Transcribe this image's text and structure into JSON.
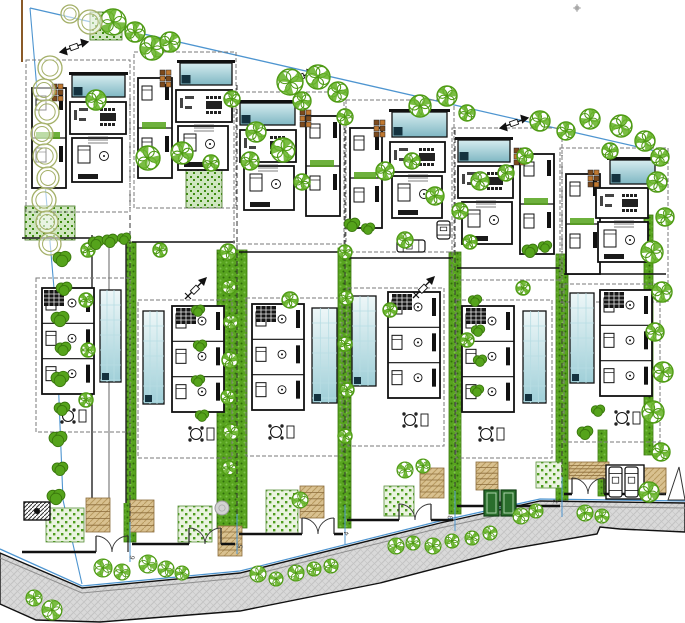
{
  "meta": {
    "type": "architectural-site-plan",
    "plots_count": 6
  },
  "canvas": {
    "w": 685,
    "h": 623,
    "bg": "#ffffff"
  },
  "colors": {
    "boundary_blue": "#4e95d0",
    "wall_black": "#111111",
    "dash_gray": "#7a7a7a",
    "road_gray": "#d9d9d9",
    "road_hatch": "#c3c3c3",
    "tree_green": "#4e9a14",
    "tree_patch": "#68b42a",
    "bush_green": "#55a31b",
    "bush_edge": "#3a770d",
    "olive": "#a4b068",
    "hedge_base": "#58a41f",
    "hedge_dark": "#2f6c0c",
    "hedge_light": "#7cc24a",
    "lawn_base": "#eaf3e0",
    "lawn_dot": "#4e9c1e",
    "garden_base": "#cfe6c0",
    "garden_dot": "#3f8c12",
    "pool_light": "#d6ecef",
    "pool_teal": "#7fb7c3",
    "pool_pale": "#eef7f8",
    "pool_mid": "#9fcfd8",
    "pool_lane": "#b7dde3",
    "navy": "#14323f",
    "tan": "#d9c190",
    "tan_line": "#b89a60",
    "tan_edge": "#8a6b3a",
    "brown_dark": "#7c4a1d",
    "brown_light": "#c07830",
    "pole_brown": "#8a5a28",
    "door_green": "#2a6e2c",
    "door_green_dark": "#123f14",
    "label_ink": "#444444"
  },
  "boundaries": {
    "top_line": [
      [
        30,
        8
      ],
      [
        660,
        152
      ]
    ],
    "left_line": [
      [
        30,
        8
      ],
      [
        55,
        300
      ],
      [
        63,
        500
      ],
      [
        82,
        584
      ]
    ],
    "front_line": [
      [
        0,
        549
      ],
      [
        82,
        586
      ],
      [
        240,
        571
      ],
      [
        440,
        521
      ],
      [
        540,
        499
      ],
      [
        685,
        501
      ]
    ],
    "marker_pole": {
      "x": 22,
      "y1": 0,
      "y2": 62
    },
    "asterisk": [
      577,
      8
    ]
  },
  "road": {
    "top": [
      [
        0,
        553
      ],
      [
        82,
        588
      ],
      [
        240,
        573
      ],
      [
        440,
        523
      ],
      [
        540,
        501
      ],
      [
        685,
        503
      ]
    ],
    "bottom": [
      [
        0,
        604
      ],
      [
        36,
        620
      ],
      [
        100,
        622
      ],
      [
        240,
        611
      ],
      [
        380,
        583
      ],
      [
        510,
        549
      ],
      [
        597,
        534
      ],
      [
        600,
        527
      ],
      [
        620,
        529
      ],
      [
        685,
        532
      ]
    ],
    "curb_offset": 5
  },
  "dividers": [
    {
      "x": 130,
      "y1": 95,
      "y2": 548
    },
    {
      "x": 237,
      "y1": 85,
      "y2": 540
    },
    {
      "x": 345,
      "y1": 120,
      "y2": 531
    },
    {
      "x": 455,
      "y1": 130,
      "y2": 517
    },
    {
      "x": 562,
      "y1": 155,
      "y2": 503
    }
  ],
  "plots": [
    {
      "label": "6",
      "x": 20,
      "w": 110,
      "wallY": 552,
      "zoneY": 238,
      "gateX": 112,
      "upper": {
        "pool": [
          72,
          75,
          53,
          22
        ],
        "wing": [
          32,
          88,
          34,
          100
        ],
        "living": [
          70,
          102,
          56,
          32
        ],
        "master": [
          72,
          138,
          50,
          44
        ],
        "dashed": [
          26,
          60,
          104,
          152
        ],
        "furn": [
          52,
          84
        ]
      },
      "lower": {
        "pool": [
          100,
          290,
          21,
          92
        ],
        "rooms": [
          42,
          288,
          52,
          106
        ],
        "dashed": [
          36,
          278,
          94,
          154
        ],
        "stairs": [
          44,
          290
        ],
        "table": [
          68,
          416
        ]
      }
    },
    {
      "label": "5",
      "x": 130,
      "w": 107,
      "wallY": 544,
      "zoneY": 242,
      "gateX": 205,
      "upper": {
        "pool": [
          180,
          63,
          52,
          22
        ],
        "wing": [
          138,
          78,
          34,
          100
        ],
        "living": [
          176,
          90,
          56,
          32
        ],
        "master": [
          178,
          126,
          50,
          44
        ],
        "dashed": [
          134,
          52,
          102,
          156
        ],
        "furn": [
          160,
          70
        ]
      },
      "lower": {
        "pool": [
          143,
          311,
          21,
          93
        ],
        "rooms": [
          172,
          306,
          52,
          106
        ],
        "dashed": [
          138,
          300,
          94,
          158
        ],
        "stairs": [
          176,
          308
        ],
        "table": [
          196,
          434
        ]
      }
    },
    {
      "label": "4",
      "x": 237,
      "w": 108,
      "wallY": 534,
      "zoneY": 252,
      "gateX": 318,
      "upper": {
        "pool": [
          240,
          103,
          55,
          22
        ],
        "wing": [
          306,
          116,
          34,
          100
        ],
        "living": [
          240,
          130,
          56,
          32
        ],
        "master": [
          244,
          166,
          50,
          44
        ],
        "dashed": [
          234,
          92,
          110,
          152
        ],
        "furn": [
          300,
          110
        ]
      },
      "lower": {
        "pool": [
          312,
          308,
          25,
          95
        ],
        "rooms": [
          252,
          304,
          52,
          106
        ],
        "dashed": [
          246,
          298,
          96,
          158
        ],
        "stairs": [
          256,
          306
        ],
        "table": [
          276,
          432
        ]
      }
    },
    {
      "label": "3",
      "x": 345,
      "w": 110,
      "wallY": 520,
      "zoneY": 258,
      "gateX": 415,
      "upper": {
        "pool": [
          392,
          112,
          55,
          25
        ],
        "wing": [
          350,
          128,
          32,
          100
        ],
        "living": [
          390,
          142,
          55,
          30
        ],
        "master": [
          392,
          176,
          50,
          42
        ],
        "dashed": [
          346,
          100,
          108,
          152
        ],
        "furn": [
          374,
          120
        ]
      },
      "lower": {
        "pool": [
          352,
          296,
          24,
          90
        ],
        "rooms": [
          388,
          292,
          52,
          106
        ],
        "dashed": [
          348,
          288,
          96,
          158
        ],
        "stairs": [
          392,
          294
        ],
        "table": [
          410,
          420
        ]
      }
    },
    {
      "label": "2",
      "x": 455,
      "w": 107,
      "wallY": 506,
      "zoneY": 268,
      "gateX": 500,
      "upper": {
        "pool": [
          458,
          140,
          52,
          22
        ],
        "wing": [
          520,
          154,
          34,
          100
        ],
        "living": [
          458,
          166,
          55,
          32
        ],
        "master": [
          462,
          202,
          50,
          42
        ],
        "dashed": [
          452,
          128,
          110,
          152
        ],
        "furn": [
          514,
          148
        ]
      },
      "lower": {
        "pool": [
          523,
          311,
          23,
          92
        ],
        "rooms": [
          462,
          306,
          52,
          106
        ],
        "dashed": [
          456,
          300,
          96,
          158
        ],
        "stairs": [
          466,
          308
        ],
        "table": [
          486,
          434
        ]
      }
    },
    {
      "label": "1",
      "x": 562,
      "w": 106,
      "wallY": 494,
      "zoneY": 274,
      "gateX": 588,
      "upper": {
        "pool": [
          610,
          160,
          45,
          24
        ],
        "wing": [
          566,
          174,
          34,
          100
        ],
        "living": [
          596,
          188,
          52,
          30
        ],
        "master": [
          598,
          222,
          50,
          40
        ],
        "dashed": [
          560,
          148,
          108,
          154
        ],
        "furn": [
          588,
          170
        ]
      },
      "lower": {
        "pool": [
          570,
          293,
          24,
          90
        ],
        "rooms": [
          600,
          290,
          52,
          106
        ],
        "dashed": [
          564,
          284,
          96,
          158
        ],
        "stairs": [
          604,
          292
        ],
        "table": [
          622,
          418
        ]
      }
    }
  ],
  "labels": [
    {
      "t": "6",
      "x": 134,
      "y": 560
    },
    {
      "t": "5",
      "x": 242,
      "y": 549
    },
    {
      "t": "4",
      "x": 348,
      "y": 536
    },
    {
      "t": "3",
      "x": 452,
      "y": 520
    },
    {
      "t": "2",
      "x": 557,
      "y": 504
    },
    {
      "t": "1",
      "x": 664,
      "y": 496
    }
  ],
  "hedges": [
    [
      124,
      242,
      12,
      300
    ],
    [
      217,
      250,
      30,
      278
    ],
    [
      338,
      248,
      13,
      280
    ],
    [
      449,
      252,
      12,
      262
    ],
    [
      556,
      254,
      12,
      246
    ],
    [
      598,
      430,
      9,
      66
    ],
    [
      644,
      215,
      9,
      240
    ]
  ],
  "lawns": [
    [
      46,
      508,
      38,
      34
    ],
    [
      178,
      506,
      34,
      36
    ],
    [
      266,
      490,
      32,
      44
    ],
    [
      384,
      486,
      30,
      30
    ],
    [
      536,
      462,
      26,
      26
    ]
  ],
  "gardens": [
    [
      186,
      166,
      36,
      42
    ],
    [
      25,
      206,
      50,
      34
    ],
    [
      90,
      12,
      32,
      28
    ]
  ],
  "walkways": [
    [
      86,
      498,
      24,
      34
    ],
    [
      130,
      500,
      24,
      32
    ],
    [
      218,
      526,
      24,
      30
    ],
    [
      300,
      486,
      24,
      32
    ],
    [
      420,
      468,
      24,
      30
    ],
    [
      476,
      462,
      22,
      28
    ],
    [
      569,
      462,
      40,
      17
    ]
  ],
  "tan_pads": [
    [
      642,
      468,
      24,
      25
    ]
  ],
  "ramp_triangle": [
    [
      668,
      500
    ],
    [
      679,
      467
    ],
    [
      685,
      500
    ]
  ],
  "driveway": {
    "lane": [
      92,
      235,
      34,
      268
    ]
  },
  "gate_box": [
    24,
    502,
    26,
    18
  ],
  "green_doors": [
    [
      484,
      490,
      15,
      26
    ],
    [
      501,
      490,
      15,
      26
    ]
  ],
  "parking": {
    "bay": [
      606,
      465,
      38,
      34
    ],
    "cars": [
      [
        609,
        467,
        13,
        30
      ],
      [
        625,
        467,
        13,
        30
      ]
    ]
  },
  "extra_cars": [
    [
      397,
      240,
      28,
      12
    ],
    [
      437,
      221,
      13,
      18
    ]
  ],
  "manholes": [
    [
      222,
      508,
      7
    ]
  ],
  "north_arrows": [
    [
      196,
      288
    ],
    [
      424,
      287
    ]
  ],
  "pole_markers": [
    [
      74,
      47
    ],
    [
      300,
      77
    ],
    [
      514,
      123
    ]
  ],
  "trees": {
    "canopy": [
      [
        113,
        22,
        13
      ],
      [
        135,
        32,
        10
      ],
      [
        152,
        48,
        12
      ],
      [
        170,
        42,
        10
      ],
      [
        96,
        100,
        10
      ],
      [
        290,
        82,
        13
      ],
      [
        318,
        77,
        12
      ],
      [
        338,
        92,
        10
      ],
      [
        302,
        101,
        9
      ],
      [
        232,
        99,
        8
      ],
      [
        256,
        132,
        10
      ],
      [
        283,
        150,
        12
      ],
      [
        345,
        117,
        8
      ],
      [
        420,
        106,
        11
      ],
      [
        447,
        96,
        10
      ],
      [
        467,
        113,
        8
      ],
      [
        540,
        121,
        10
      ],
      [
        566,
        131,
        9
      ],
      [
        590,
        119,
        10
      ],
      [
        621,
        126,
        11
      ],
      [
        645,
        141,
        10
      ],
      [
        660,
        157,
        9
      ],
      [
        610,
        151,
        8
      ],
      [
        525,
        156,
        8
      ],
      [
        148,
        158,
        12
      ],
      [
        182,
        153,
        11
      ],
      [
        211,
        163,
        8
      ],
      [
        250,
        161,
        9
      ],
      [
        302,
        182,
        8
      ],
      [
        385,
        171,
        9
      ],
      [
        412,
        161,
        8
      ],
      [
        480,
        181,
        9
      ],
      [
        506,
        173,
        8
      ],
      [
        435,
        196,
        9
      ],
      [
        460,
        211,
        8
      ],
      [
        657,
        182,
        10
      ],
      [
        665,
        217,
        9
      ],
      [
        652,
        252,
        11
      ],
      [
        662,
        292,
        10
      ],
      [
        655,
        332,
        9
      ],
      [
        663,
        372,
        10
      ],
      [
        653,
        412,
        11
      ],
      [
        661,
        452,
        9
      ],
      [
        649,
        492,
        10
      ],
      [
        228,
        252,
        8
      ],
      [
        229,
        287,
        7
      ],
      [
        231,
        322,
        7
      ],
      [
        230,
        360,
        8
      ],
      [
        228,
        397,
        7
      ],
      [
        231,
        432,
        8
      ],
      [
        229,
        468,
        7
      ],
      [
        345,
        252,
        7
      ],
      [
        346,
        298,
        7
      ],
      [
        345,
        344,
        7
      ],
      [
        347,
        390,
        7
      ],
      [
        345,
        436,
        7
      ],
      [
        405,
        240,
        8
      ],
      [
        470,
        242,
        7
      ],
      [
        290,
        300,
        8
      ],
      [
        390,
        310,
        7
      ],
      [
        523,
        288,
        7
      ],
      [
        467,
        340,
        7
      ],
      [
        160,
        250,
        7
      ],
      [
        88,
        250,
        7
      ],
      [
        86,
        300,
        7
      ],
      [
        88,
        350,
        7
      ],
      [
        86,
        400,
        7
      ]
    ],
    "street": [
      [
        103,
        568,
        9
      ],
      [
        122,
        572,
        8
      ],
      [
        148,
        564,
        9
      ],
      [
        166,
        569,
        8
      ],
      [
        182,
        573,
        7
      ],
      [
        258,
        574,
        8
      ],
      [
        276,
        579,
        7
      ],
      [
        296,
        573,
        8
      ],
      [
        314,
        569,
        7
      ],
      [
        331,
        566,
        7
      ],
      [
        396,
        546,
        8
      ],
      [
        413,
        543,
        7
      ],
      [
        433,
        546,
        8
      ],
      [
        452,
        541,
        7
      ],
      [
        472,
        538,
        7
      ],
      [
        490,
        533,
        7
      ],
      [
        521,
        516,
        8
      ],
      [
        536,
        511,
        7
      ],
      [
        585,
        513,
        8
      ],
      [
        602,
        516,
        7
      ],
      [
        300,
        500,
        8
      ],
      [
        52,
        610,
        10
      ],
      [
        34,
        598,
        8
      ],
      [
        405,
        470,
        8
      ],
      [
        423,
        466,
        7
      ]
    ],
    "olive": [
      [
        50,
        68,
        12
      ],
      [
        44,
        90,
        11
      ],
      [
        47,
        112,
        12
      ],
      [
        42,
        134,
        11
      ],
      [
        45,
        156,
        12
      ],
      [
        48,
        178,
        11
      ],
      [
        44,
        200,
        12
      ],
      [
        47,
        222,
        11
      ],
      [
        50,
        244,
        11
      ],
      [
        90,
        22,
        12
      ],
      [
        70,
        14,
        9
      ]
    ],
    "bush": [
      [
        62,
        258,
        8
      ],
      [
        64,
        288,
        7
      ],
      [
        60,
        318,
        8
      ],
      [
        63,
        348,
        7
      ],
      [
        60,
        378,
        8
      ],
      [
        62,
        408,
        7
      ],
      [
        58,
        438,
        8
      ],
      [
        60,
        468,
        7
      ],
      [
        56,
        496,
        8
      ],
      [
        96,
        242,
        7
      ],
      [
        110,
        240,
        7
      ],
      [
        124,
        238,
        6
      ],
      [
        352,
        224,
        7
      ],
      [
        368,
        228,
        6
      ],
      [
        530,
        250,
        7
      ],
      [
        545,
        246,
        6
      ],
      [
        585,
        432,
        7
      ],
      [
        598,
        410,
        6
      ],
      [
        475,
        300,
        6
      ],
      [
        478,
        330,
        6
      ],
      [
        480,
        360,
        6
      ],
      [
        477,
        390,
        6
      ],
      [
        198,
        310,
        6
      ],
      [
        200,
        345,
        6
      ],
      [
        198,
        380,
        6
      ],
      [
        202,
        415,
        6
      ]
    ]
  }
}
